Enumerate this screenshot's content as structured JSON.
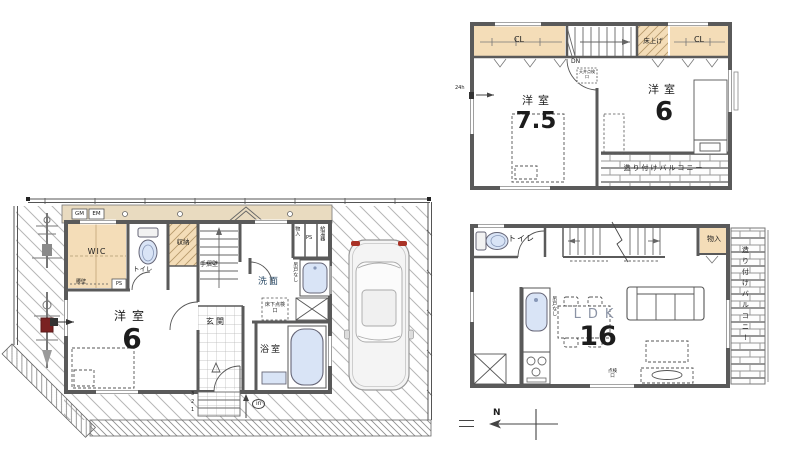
{
  "colors": {
    "wall": "#5a5a5a",
    "closet_fill": "#f4ddb8",
    "fixture_fill": "#d9e4f6",
    "approach_fill": "#e9dbc0",
    "accent_red": "#a93226"
  },
  "plan_1f": {
    "approach": {
      "gas_meter": "GM",
      "electric_meter": "EM"
    },
    "rooms": {
      "wic": "WIC",
      "toilet": "トイレ",
      "storage": "収納",
      "washroom": "洗面",
      "bathroom": "浴室",
      "entrance": "玄関",
      "western_room": "洋室",
      "western_room_size": "6"
    },
    "labels": {
      "waist_wall": "腰壁",
      "pipe_space": "PS",
      "handrail_wall": "手摺壁",
      "small_storage": "物入",
      "pipe_space_2": "PS",
      "water_heater": "給湯器",
      "no_hanging_cupboard": "吊戸なし",
      "underfloor_access": "床下点検口",
      "step_3": "3",
      "step_2": "2",
      "step_1": "1",
      "entry": "in"
    }
  },
  "plan_2f": {
    "rooms": {
      "toilet": "トイレ",
      "storage": "物入",
      "ldk": "LDK",
      "ldk_size": "16",
      "balcony": "造り付けバルコニー"
    },
    "labels": {
      "no_hanging_cupboard": "吊戸なし",
      "access_hatch": "点検口"
    }
  },
  "plan_3f": {
    "rooms": {
      "closet_left": "CL",
      "closet_right": "CL",
      "raised_floor": "床上げ",
      "western_room_a": "洋室",
      "western_room_a_size": "7.5",
      "western_room_b": "洋室",
      "western_room_b_size": "6",
      "balcony": "造り付けバルコニー"
    },
    "labels": {
      "down": "DN",
      "vent_24h": "24h",
      "ceiling_access": "天井点検口"
    }
  },
  "compass": {
    "north": "N"
  }
}
